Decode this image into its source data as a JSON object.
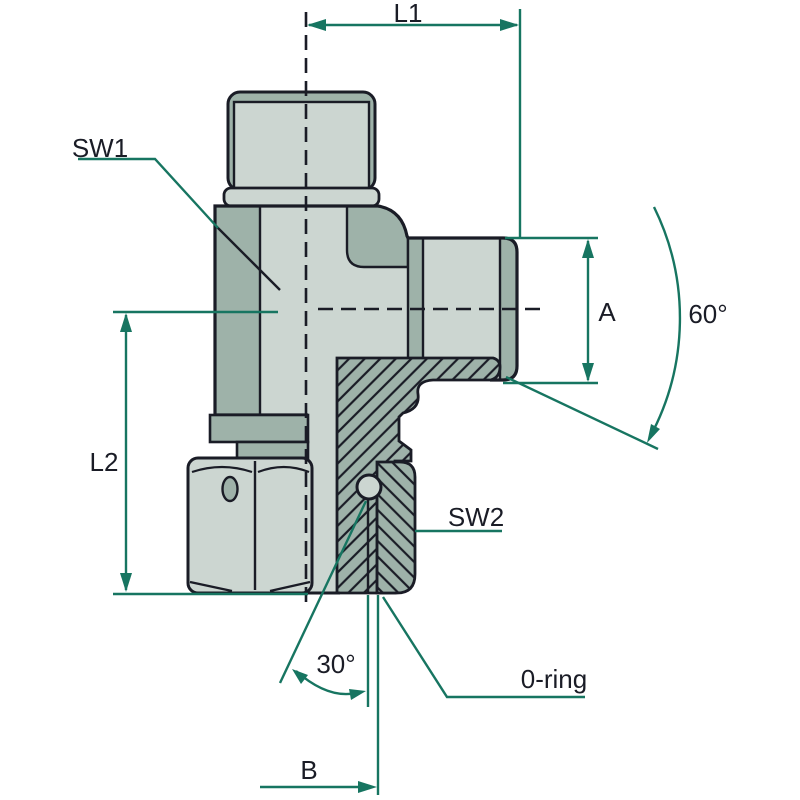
{
  "labels": {
    "l1": "L1",
    "sw1": "SW1",
    "l2": "L2",
    "a": "A",
    "seat_angle": "60°",
    "sw2": "SW2",
    "cone_angle": "30°",
    "oring": "0-ring",
    "b": "B"
  },
  "colors": {
    "outline": "#1a1c26",
    "dimension": "#177561",
    "fill_light": "#ccd6d1",
    "fill_mid": "#9eb2a9",
    "background": "#ffffff"
  }
}
